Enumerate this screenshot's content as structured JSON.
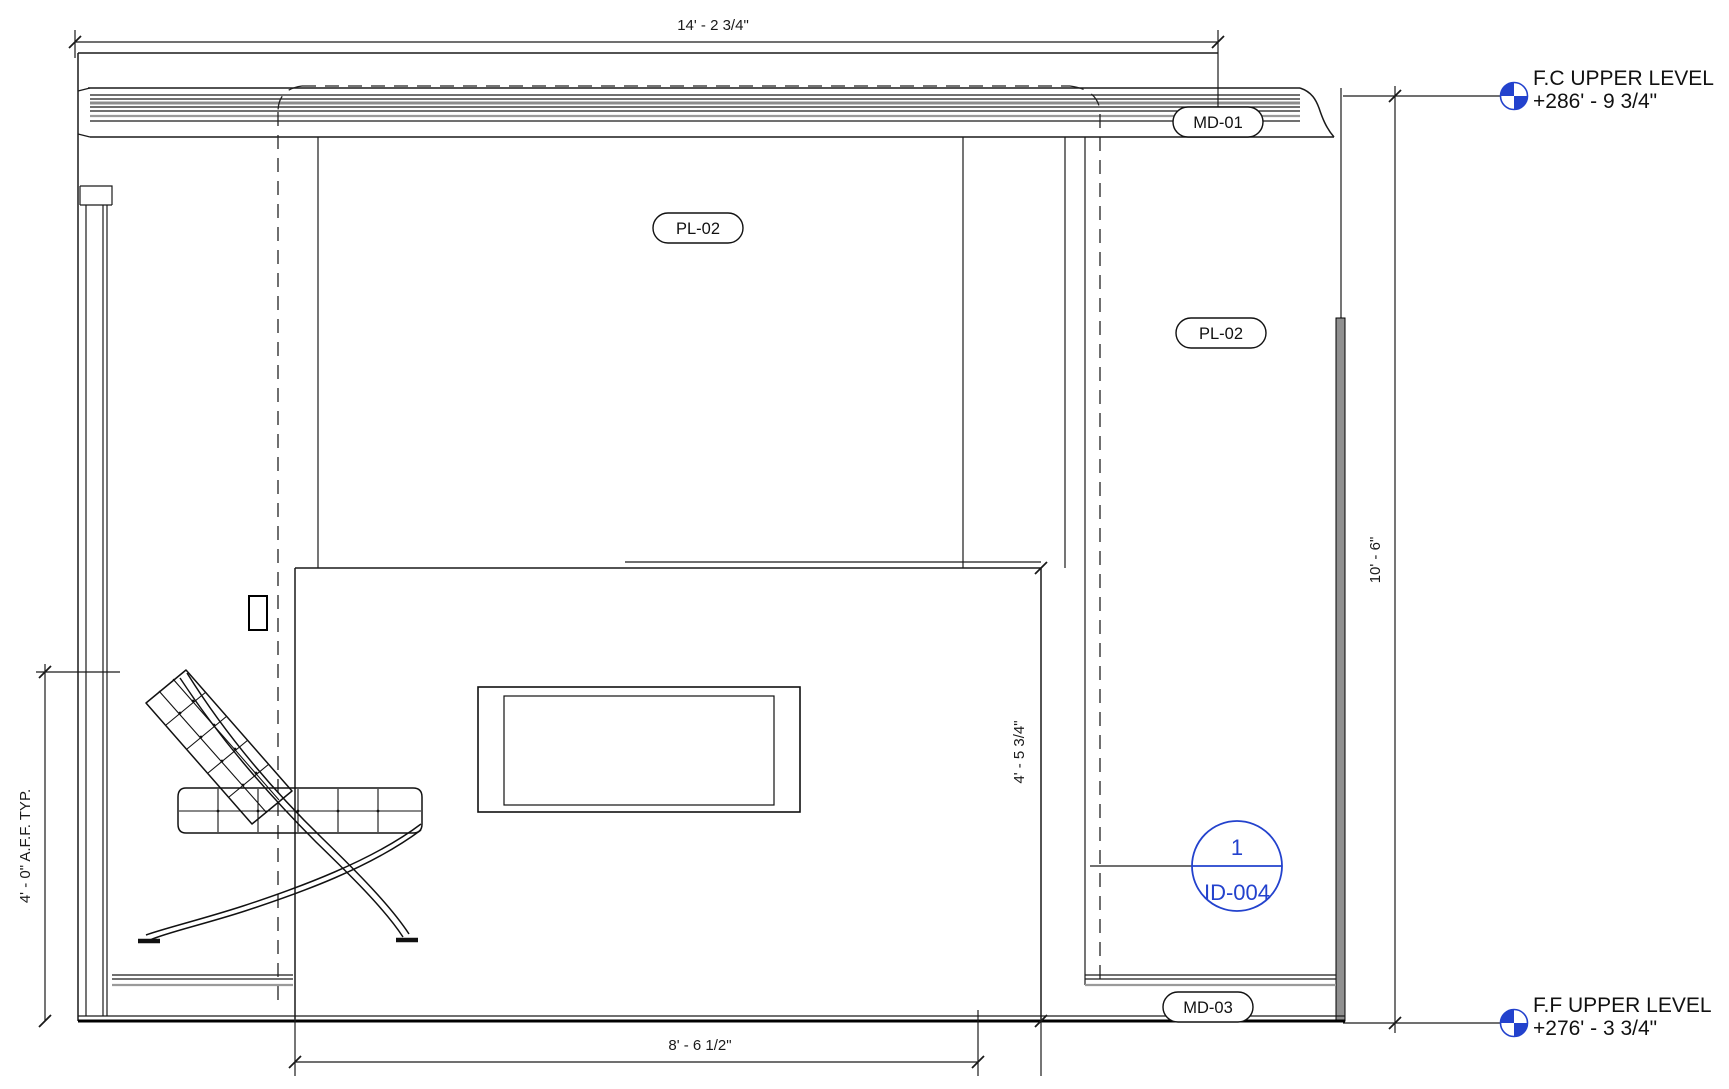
{
  "drawing": {
    "dimensions": {
      "top_width": "14' - 2 3/4\"",
      "bottom_width": "8' - 6 1/2\"",
      "right_height": "10' - 6\"",
      "fireplace_height": "4' - 5 3/4\"",
      "left_aff": "4' - 0\" A.F.F. TYP."
    },
    "levels": {
      "fc": {
        "name": "F.C UPPER LEVEL",
        "elevation": "+286' - 9 3/4\""
      },
      "ff": {
        "name": "F.F UPPER LEVEL",
        "elevation": "+276' - 3 3/4\""
      }
    },
    "tags": {
      "crown_molding": "MD-01",
      "wall_panel_center": "PL-02",
      "wall_panel_right": "PL-02",
      "base_molding": "MD-03"
    },
    "callout": {
      "detail_number": "1",
      "sheet_number": "ID-004"
    },
    "colors": {
      "annotation_blue": "#2342cd",
      "line_black": "#1a1a1a",
      "molding_gray": "#8d8d8d"
    }
  }
}
